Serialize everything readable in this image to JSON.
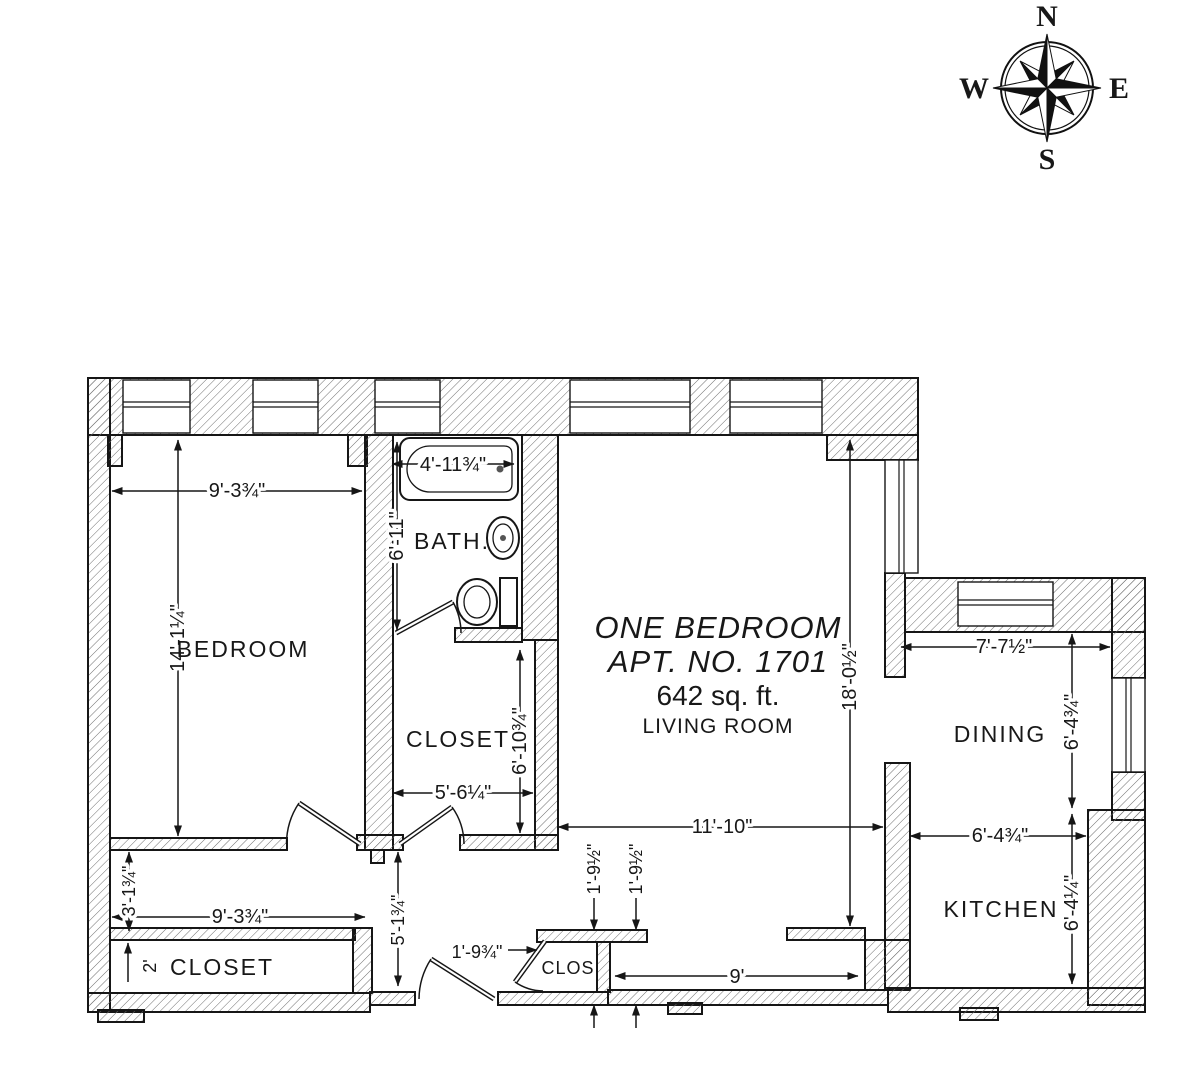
{
  "compass": {
    "north": "N",
    "east": "E",
    "south": "S",
    "west": "W"
  },
  "title": {
    "line1": "ONE BEDROOM",
    "line2": "APT. NO. 1701",
    "line3": "642 sq. ft.",
    "line4": "LIVING ROOM"
  },
  "labels": {
    "bedroom": "BEDROOM",
    "bath": "BATH.",
    "closet_mid": "CLOSET",
    "dining": "DINING",
    "kitchen": "KITCHEN",
    "closet_bottom": "CLOSET",
    "closet_entry": "CLOS."
  },
  "dimensions": {
    "bedroom_width": "9'-3¾\"",
    "bedroom_height": "14'-1¼\"",
    "tub_width": "4'-11¾\"",
    "bath_height": "6'-11\"",
    "closet_mid_width": "5'-6¼\"",
    "closet_mid_height": "6'-10¾\"",
    "living_height": "18'-0½\"",
    "living_width": "11'-10\"",
    "dining_width": "7'-7½\"",
    "dining_height": "6'-4¾\"",
    "kitchen_width": "6'-4¾\"",
    "kitchen_height": "6'-4¼\"",
    "hall_height": "3'-1¾\"",
    "hall_width": "9'-3¾\"",
    "closet_bottom_depth": "2'",
    "vestibule_height": "5'-1¾\"",
    "entry_door": "1'-9¾\"",
    "entry_closet_1": "1'-9½\"",
    "entry_closet_2": "1'-9½\"",
    "foyer_hall_width": "9'"
  }
}
